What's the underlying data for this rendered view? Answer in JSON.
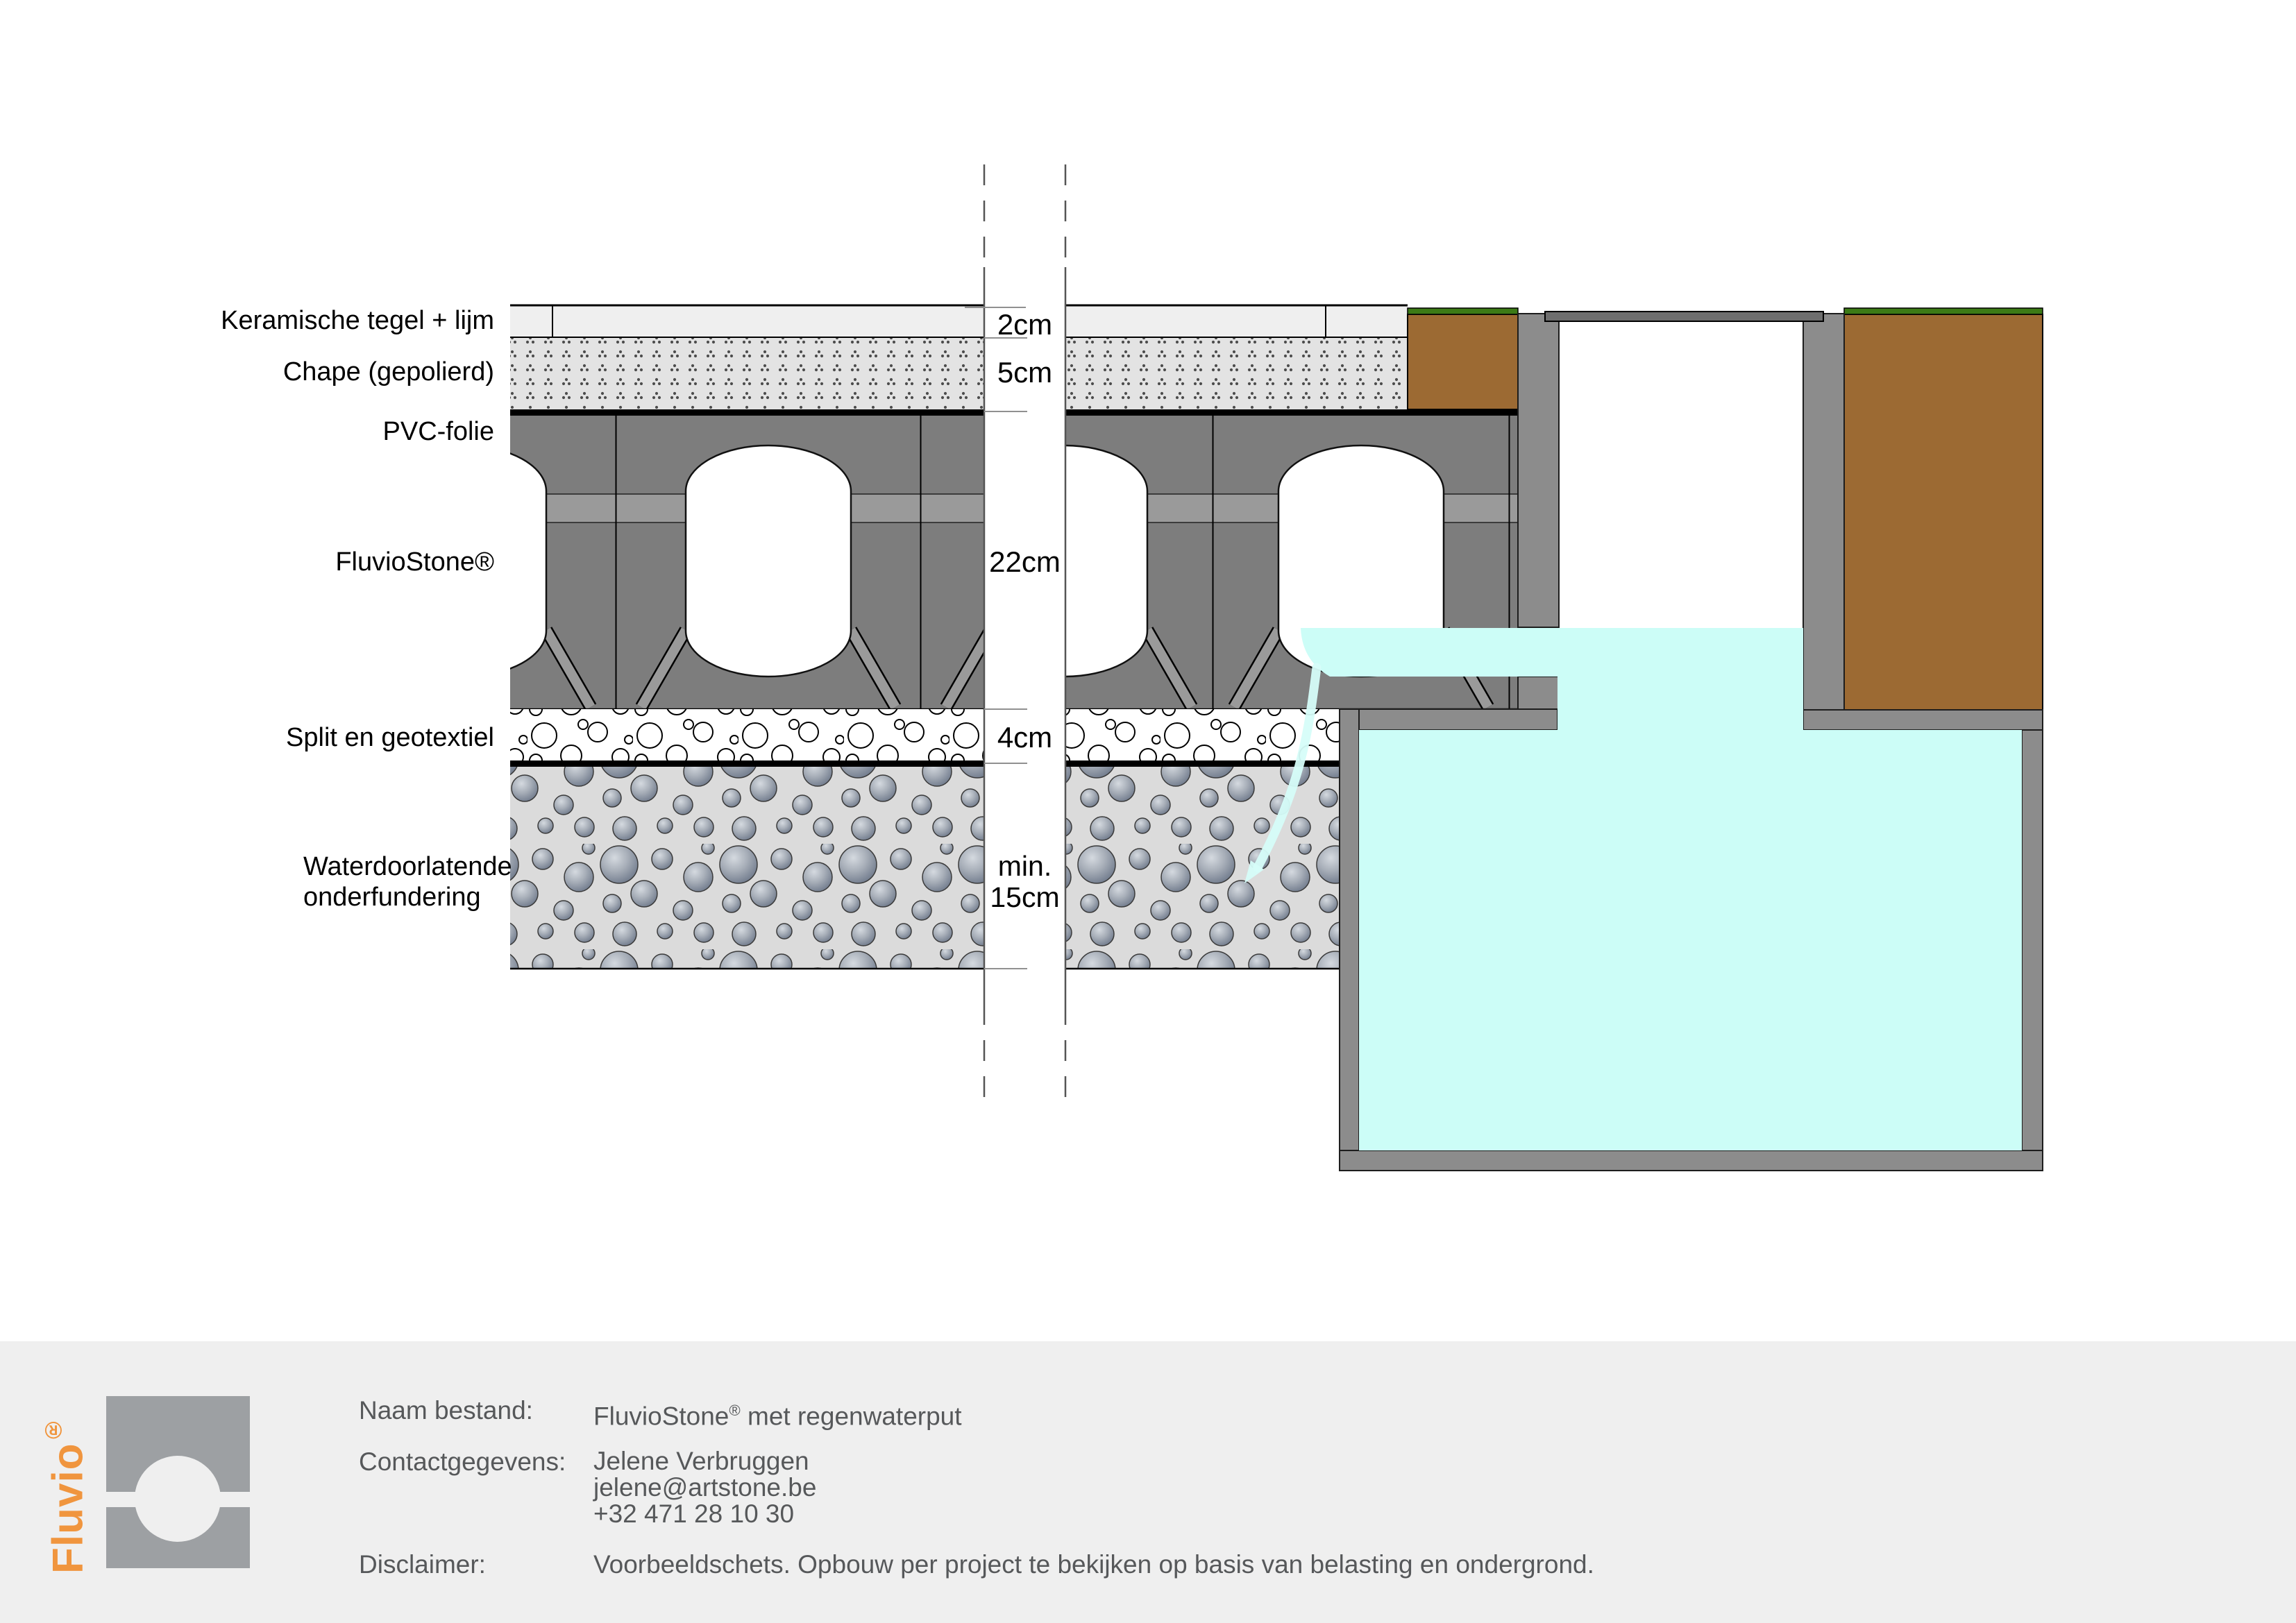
{
  "diagram": {
    "layer_labels": {
      "tile": "Keramische tegel + lijm",
      "chape": "Chape (gepolierd)",
      "pvc": "PVC-folie",
      "stone": "FluvioStone®",
      "split": "Split en geotextiel",
      "base_line1": "Waterdoorlatende",
      "base_line2": "onderfundering"
    },
    "dimensions": {
      "tile": "2cm",
      "chape": "5cm",
      "stone": "22cm",
      "split": "4cm",
      "base_line1": "min.",
      "base_line2": "15cm"
    },
    "colors": {
      "water": "#ccfdf7",
      "soil_brown": "#9c6a33",
      "grass_green": "#3c7a16",
      "stone_gray": "#7d7d7d",
      "tank_gray": "#8c8c8c",
      "accent_orange": "#f0953e",
      "footer_bg": "#efefef"
    }
  },
  "footer": {
    "brand": {
      "name": "Fluvio",
      "reg": "®"
    },
    "fields": [
      {
        "label": "Naam bestand:",
        "value_pre": "FluvioStone",
        "value_reg": "®",
        "value_post": " met regenwaterput"
      },
      {
        "label": "Contactgegevens:",
        "lines": [
          "Jelene Verbruggen",
          "jelene@artstone.be",
          "+32 471 28 10 30"
        ]
      },
      {
        "label": "Disclaimer:",
        "value": "Voorbeeldschets. Opbouw per project te bekijken op basis van belasting en ondergrond."
      }
    ]
  }
}
